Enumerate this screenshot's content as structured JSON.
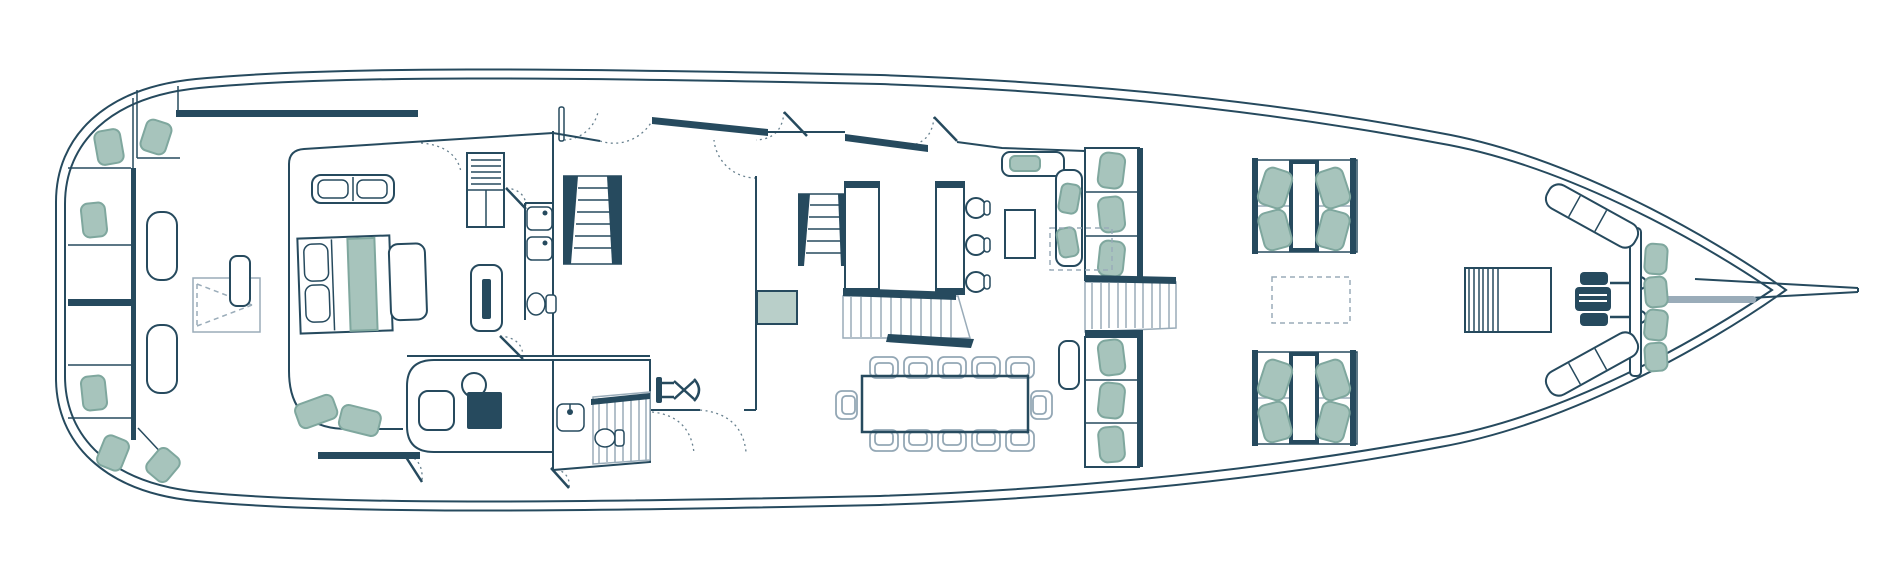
{
  "meta": {
    "title": "Yacht main deck floor plan",
    "orientation": {
      "stern": "left",
      "bow": "right"
    },
    "visible_text": []
  },
  "colors": {
    "outline": "#264a5e",
    "cushion_fill": "#a7c4bc",
    "cushion_border": "#7fa79e",
    "pale_step": "#b9cfc9",
    "light_line": "#9aacb9",
    "chair_line": "#93a7b5",
    "background": "#ffffff"
  },
  "inventory": {
    "hull": {
      "bowsprit": true,
      "double_line_hull": true
    },
    "aft_deck": {
      "bench_cushions": 6,
      "loungers": 2,
      "tables_with_dashed_leaf": 1
    },
    "master_cabin": {
      "double_bed": 1,
      "pillows": 2,
      "bed_runner": 1,
      "headboard_seats": 2,
      "footboard_bench": 1,
      "nightstand": 1,
      "sofa_cushions": 2,
      "wardrobe": 1,
      "tv_cabinet": 1
    },
    "forward_bathroom": {
      "sinks": 2,
      "toilet": 1
    },
    "aft_bathroom": {
      "sinks": 1,
      "toilet": 1
    },
    "staircases": {
      "main": 1,
      "mid": 1,
      "cockpit_steps": 1,
      "aft_side": 1,
      "gangway_slats": 1
    },
    "salon": {
      "galley_counters": 2,
      "bar_stools": 3,
      "dinette_cushions": 3,
      "side_table": 1,
      "sliding_door_panels": 2,
      "door_swings": 8,
      "pale_step": 1
    },
    "starboard_banks": {
      "upper_seats": 3,
      "lower_seats": 3,
      "daybed": 1
    },
    "office": {
      "desk": 1,
      "round_chair": 1,
      "seat": 1
    },
    "gym_equipment": 1,
    "cockpit_dining": {
      "table": 1,
      "chairs": 12
    },
    "foredeck": {
      "seating_clusters": 2,
      "seats_per_cluster": 4,
      "cluster_tables": 2,
      "dashed_skylights": 2,
      "slatted_deck_box": 1,
      "windlass": 1,
      "bow_bench_cushions": 4,
      "angled_side_benches": 2
    }
  }
}
